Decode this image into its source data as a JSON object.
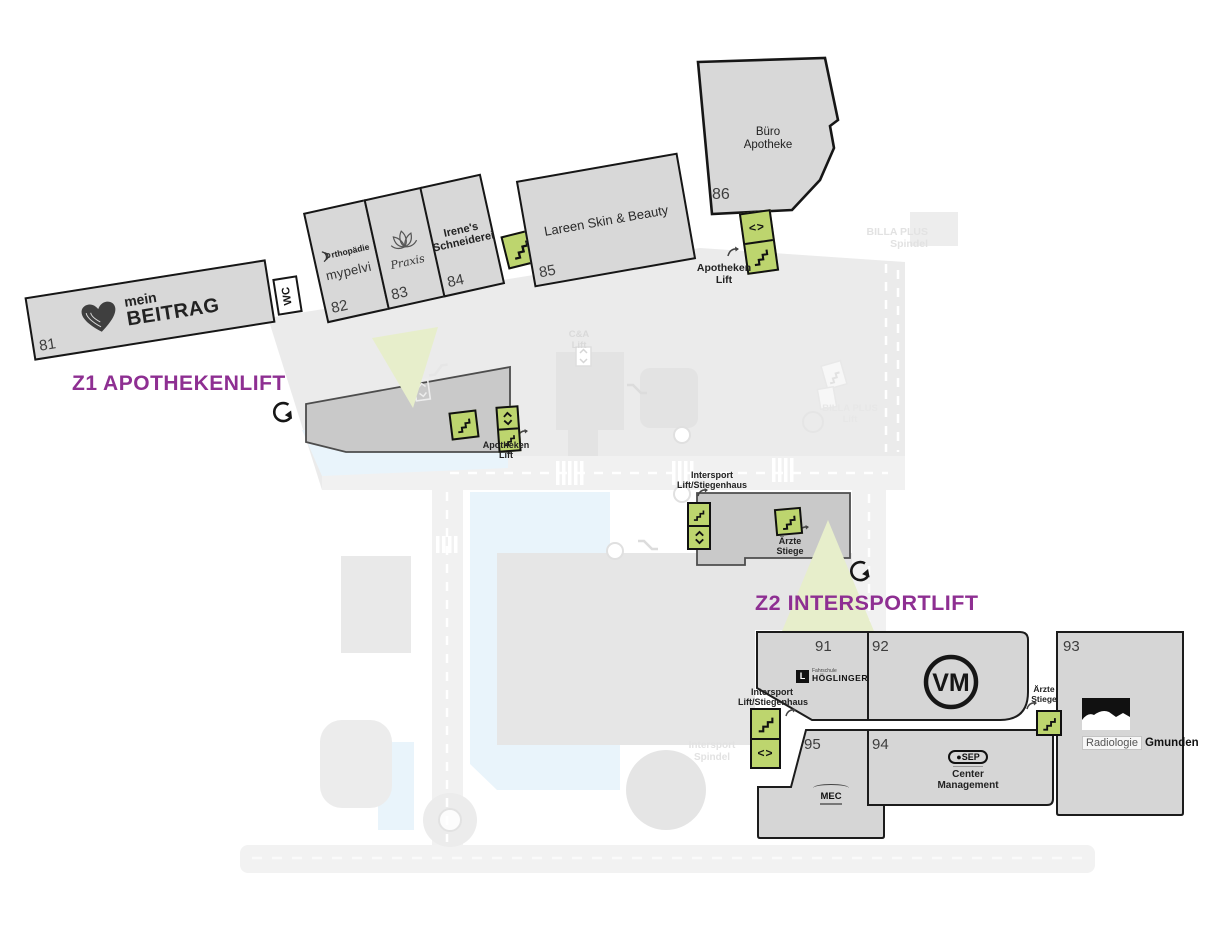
{
  "titles": {
    "z1": "Z1 APOTHEKENLIFT",
    "z2": "Z2 INTERSPORTLIFT"
  },
  "colors": {
    "accent_purple": "#8e2f92",
    "lift_green": "#bdd56e",
    "beam_green": "#e7eecb",
    "building_gray": "#d8d8d8",
    "mid_building_gray": "#c9c9c9",
    "water_blue": "#e9f4fb"
  },
  "units": {
    "u81": {
      "number": "81",
      "brand_top": "mein",
      "brand_bottom": "BEITRAG"
    },
    "u82": {
      "number": "82",
      "brand1": "rthopädie",
      "brand2": "mypelvi"
    },
    "u83": {
      "number": "83",
      "brand": "Praxis"
    },
    "u84": {
      "number": "84",
      "name1": "Irene's",
      "name2": "Schneiderei"
    },
    "u85": {
      "number": "85",
      "name": "Lareen Skin & Beauty"
    },
    "u86": {
      "number": "86",
      "name1": "Büro",
      "name2": "Apotheke"
    },
    "u91": {
      "number": "91",
      "logo_mark": "L",
      "brand_top": "Fahrschule",
      "brand": "HÖGLINGER"
    },
    "u92": {
      "number": "92",
      "monogram": "VM"
    },
    "u93": {
      "number": "93",
      "brand_box": "Radiologie",
      "brand": "Gmunden"
    },
    "u94": {
      "number": "94",
      "logo": "SEP",
      "name1": "Center",
      "name2": "Management"
    },
    "u95": {
      "number": "95",
      "logo": "MEC"
    }
  },
  "labels": {
    "wc": "WC",
    "apotheken": "Apotheken",
    "lift": "Lift",
    "billa_plus": "BILLA PLUS",
    "spindel": "Spindel",
    "ca": "C&A",
    "intersport": "Intersport",
    "lift_stiegenhaus": "Lift/Stiegenhaus",
    "aerzte": "Ärzte",
    "stiege": "Stiege"
  },
  "glyphs": {
    "lift_horizontal": "<>"
  }
}
